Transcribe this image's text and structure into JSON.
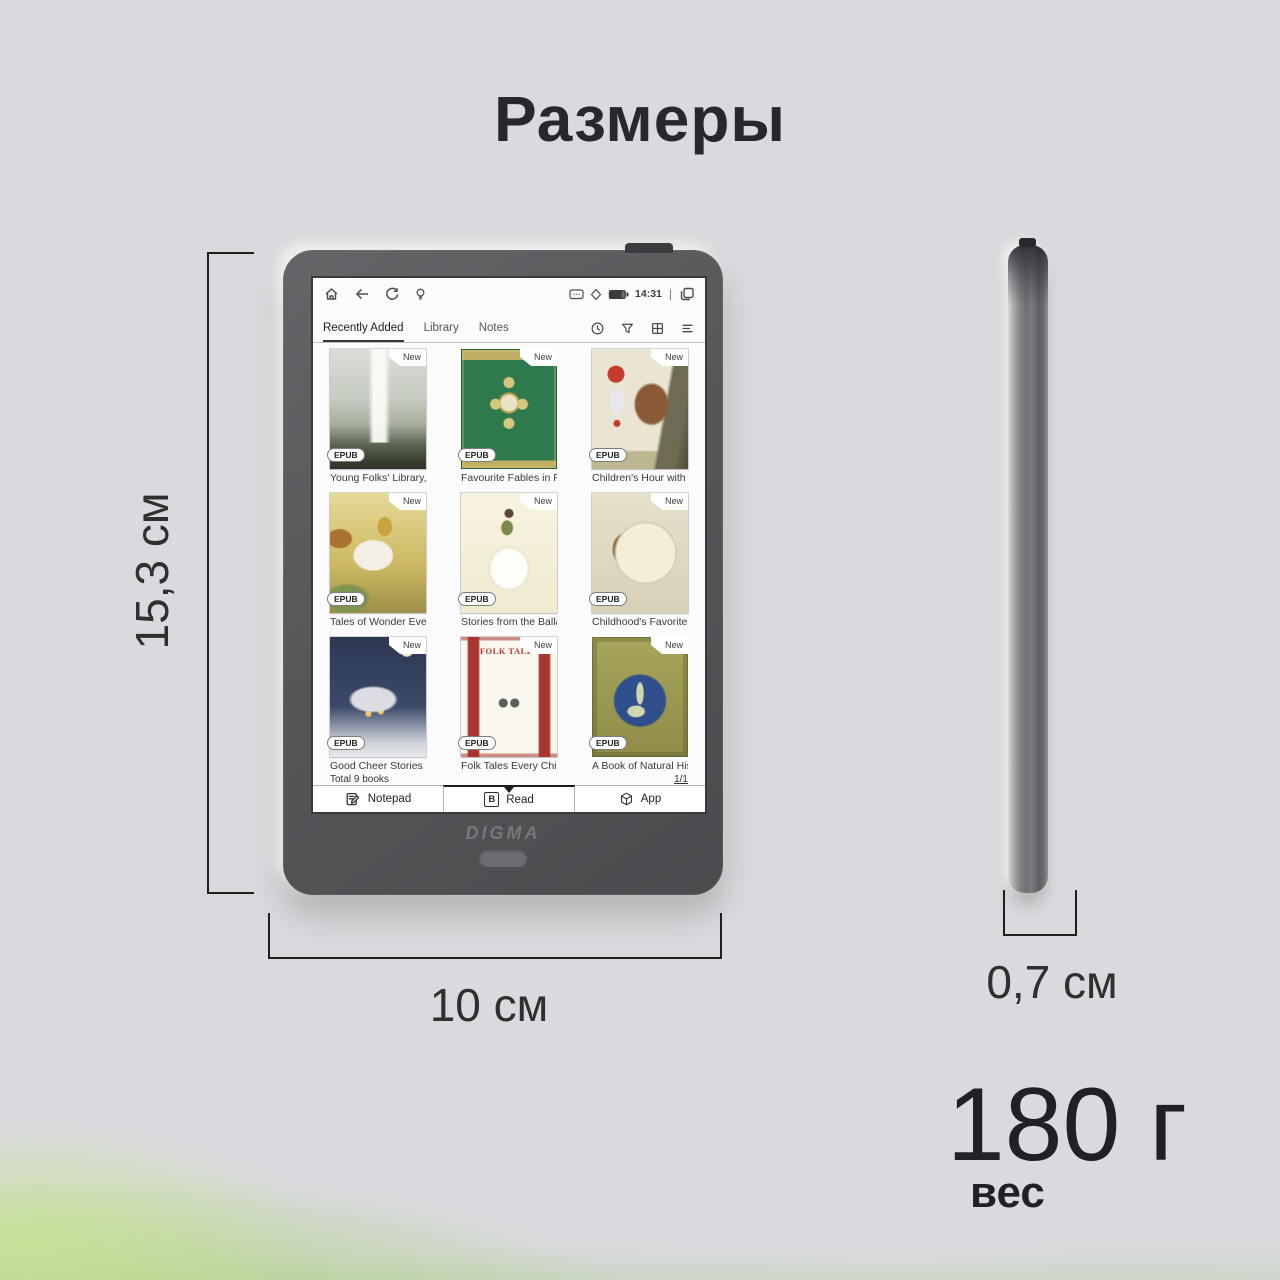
{
  "page": {
    "title": "Размеры"
  },
  "dimensions": {
    "height_label": "15,3 см",
    "width_label": "10 см",
    "depth_label": "0,7 см"
  },
  "weight": {
    "value": "180 г",
    "label": "вес"
  },
  "device": {
    "brand": "DIGMA",
    "status_bar": {
      "time": "14:31",
      "separator": "|",
      "left_icons": [
        "home-icon",
        "back-icon",
        "sync-icon",
        "frontlight-icon"
      ],
      "right_icons": [
        "message-icon",
        "diamond-icon",
        "battery-icon",
        "recents-icon"
      ]
    },
    "tabs": [
      {
        "label": "Recently Added",
        "active": true
      },
      {
        "label": "Library",
        "active": false
      },
      {
        "label": "Notes",
        "active": false
      }
    ],
    "toolbar_icons": [
      "history-icon",
      "filter-icon",
      "grid-view-icon",
      "menu-icon"
    ],
    "books": [
      {
        "title": "Young Folks' Library, V...",
        "format": "EPUB",
        "badge": "New",
        "cover_text": ""
      },
      {
        "title": "Favourite Fables in Pro...",
        "format": "EPUB",
        "badge": "New",
        "cover_text": ""
      },
      {
        "title": "Children's Hour with Re...",
        "format": "EPUB",
        "badge": "New",
        "cover_text": ""
      },
      {
        "title": "Tales of Wonder Every ...",
        "format": "EPUB",
        "badge": "New",
        "cover_text": ""
      },
      {
        "title": "Stories from the Ballad...",
        "format": "EPUB",
        "badge": "New",
        "cover_text": ""
      },
      {
        "title": "Childhood's Favorites a...",
        "format": "EPUB",
        "badge": "New",
        "cover_text": ""
      },
      {
        "title": "Good Cheer Stories Eve...",
        "format": "EPUB",
        "badge": "New",
        "cover_text": ""
      },
      {
        "title": "Folk Tales Every Child S...",
        "format": "EPUB",
        "badge": "New",
        "cover_text": "FOLK TALES"
      },
      {
        "title": "A Book of Natural Hist...",
        "format": "EPUB",
        "badge": "New",
        "cover_text": ""
      }
    ],
    "footer": {
      "total": "Total 9 books",
      "page_indicator": "1/1"
    },
    "nav": [
      {
        "label": "Notepad",
        "active": false
      },
      {
        "label": "Read",
        "active": true
      },
      {
        "label": "App",
        "active": false
      }
    ]
  }
}
